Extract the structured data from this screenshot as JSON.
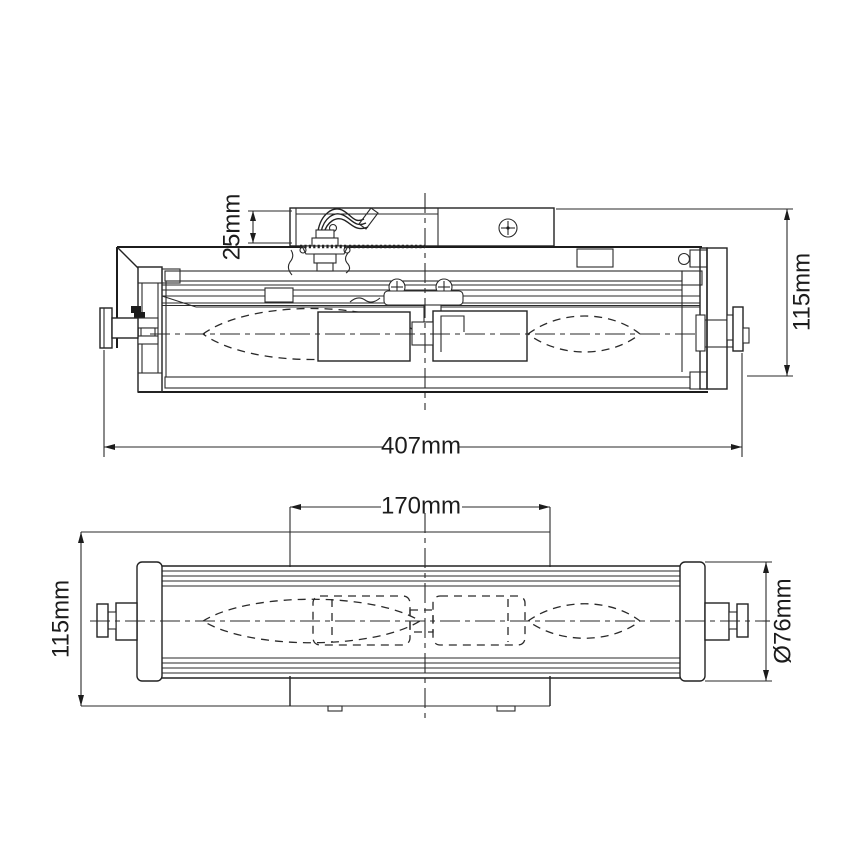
{
  "drawing": {
    "title": "wall-light technical drawing, two orthographic views",
    "background": "#ffffff",
    "line_color": "#222222",
    "views": {
      "side": {
        "name": "side section view",
        "dims": {
          "bracket_depth": {
            "label": "25mm"
          },
          "overall_height": {
            "label": "115mm"
          },
          "overall_width": {
            "label": "407mm"
          }
        }
      },
      "plan": {
        "name": "bottom plan view",
        "dims": {
          "backplate_width": {
            "label": "170mm"
          },
          "backplate_height": {
            "label": "115mm"
          },
          "tube_diameter": {
            "label": "Ø76mm"
          }
        }
      }
    }
  }
}
